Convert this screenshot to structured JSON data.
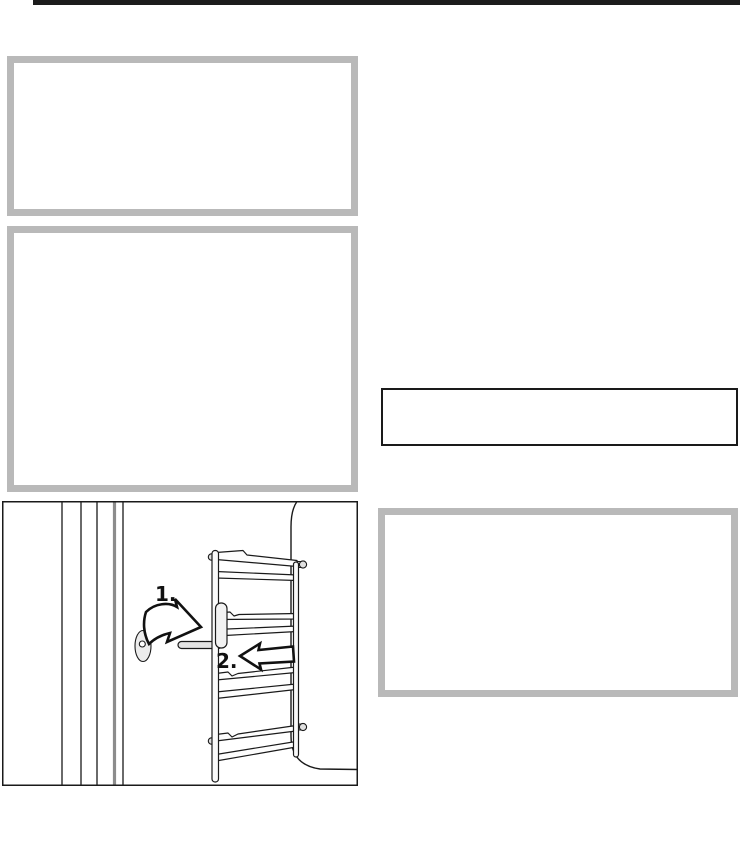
{
  "colors": {
    "page_bg": "#ffffff",
    "top_rule": "#1c1c1c",
    "box_border": "#b9b9b9",
    "line": "#1a1a1a",
    "line_soft": "#8c8c8c",
    "fill_soft": "#e7e7e7"
  },
  "illustration": {
    "label": "side-runner-removal-diagram",
    "steps": [
      {
        "label": "1."
      },
      {
        "label": "2."
      }
    ]
  }
}
